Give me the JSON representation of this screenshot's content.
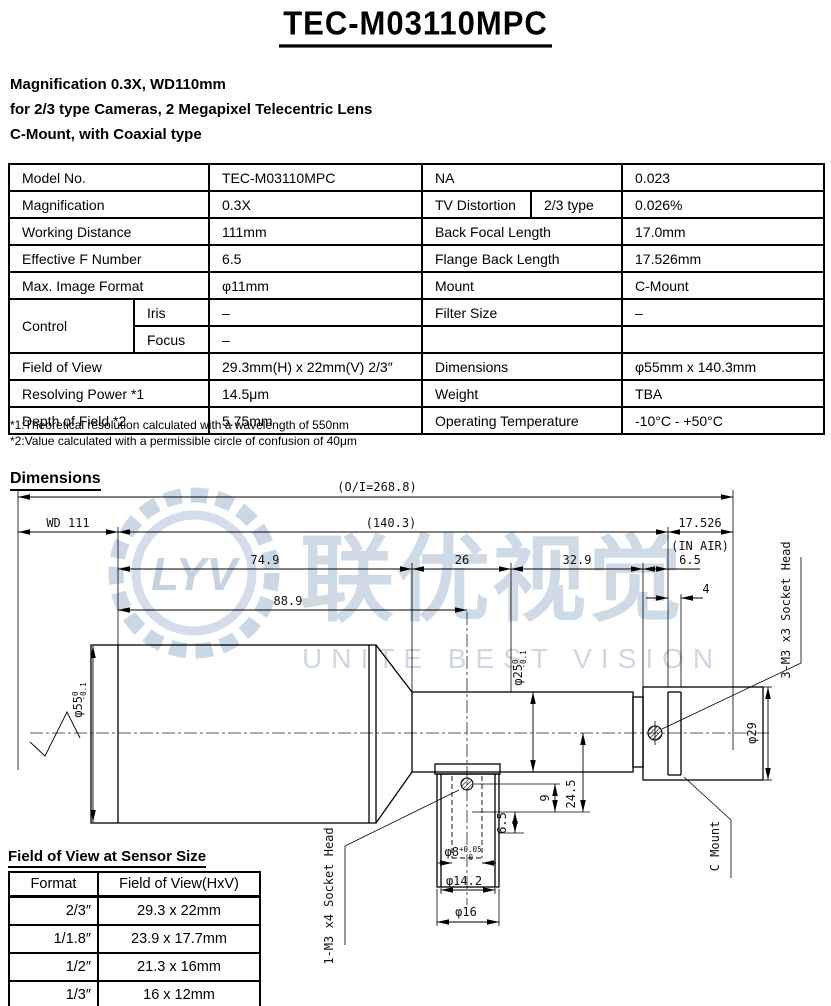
{
  "title": "TEC-M03110MPC",
  "subtitle_lines": [
    "Magnification 0.3X, WD110mm",
    "for 2/3 type Cameras, 2 Megapixel Telecentric Lens",
    "C-Mount, with Coaxial type"
  ],
  "spec_table": {
    "rows": [
      {
        "c": [
          "Model No.",
          "TEC-M03110MPC",
          "NA",
          "0.023"
        ]
      },
      {
        "c": [
          "Magnification",
          "0.3X",
          "TV Distortion",
          "2/3 type",
          "0.026%"
        ]
      },
      {
        "c": [
          "Working Distance",
          "111mm",
          "Back Focal Length",
          "17.0mm"
        ]
      },
      {
        "c": [
          "Effective F Number",
          "6.5",
          "Flange Back Length",
          "17.526mm"
        ]
      },
      {
        "c": [
          "Max. Image Format",
          "φ11mm",
          "Mount",
          "C-Mount"
        ]
      },
      {
        "c": [
          "Control",
          "Iris",
          "–",
          "Filter Size",
          "–"
        ]
      },
      {
        "c": [
          "Focus",
          "–",
          "",
          ""
        ]
      },
      {
        "c": [
          "Field of View",
          "29.3mm(H) x 22mm(V) 2/3″",
          "Dimensions",
          "φ55mm x 140.3mm"
        ]
      },
      {
        "c": [
          "Resolving Power *1",
          "14.5μm",
          "Weight",
          "TBA"
        ]
      },
      {
        "c": [
          "Depth of Field *2",
          "5.75mm",
          "Operating Temperature",
          "-10°C - +50°C"
        ]
      }
    ]
  },
  "footnotes": [
    "*1:Theoretical resolution calculated with a wavelength of 550nm",
    "*2:Value calculated with a permissible circle of confusion of 40μm"
  ],
  "drawing": {
    "heading": "Dimensions",
    "dims": {
      "overall": "(O/I=268.8)",
      "wd": "WD 111",
      "body": "(140.3)",
      "flange_back": "17.526",
      "in_air": "(IN AIR)",
      "front_len": "74.9",
      "mid_len": "26",
      "rear_len": "32.9",
      "rear_small": "6.5",
      "lip": "4",
      "port_center": "88.9",
      "port_9": "9",
      "port_245": "24.5",
      "port_65": "6.5"
    },
    "diameters": {
      "phi55": "φ55",
      "phi55_sup": "0",
      "phi55_sub": "-0.1",
      "phi25": "φ25",
      "phi25_sup": "0",
      "phi25_sub": "-0.1",
      "phi29": "φ29",
      "phi8": "φ8",
      "phi8_sup": "+0.05",
      "phi8_sub": "0",
      "phi14_2": "φ14.2",
      "phi16": "φ16"
    },
    "labels": {
      "socket3": "3-M3 x3 Socket Head",
      "socket1": "1-M3 x4 Socket Head",
      "cmount": "C Mount"
    },
    "watermark": {
      "logo": "LYV",
      "cn": "联优视觉",
      "en": "UNITE BEST VISION"
    }
  },
  "fov_table": {
    "title": "Field of View at Sensor Size",
    "headers": [
      "Format",
      "Field of View(HxV)"
    ],
    "rows": [
      [
        "2/3″",
        "29.3 x 22mm"
      ],
      [
        "1/1.8″",
        "23.9 x 17.7mm"
      ],
      [
        "1/2″",
        "21.3 x 16mm"
      ],
      [
        "1/3″",
        "16 x 12mm"
      ]
    ]
  }
}
